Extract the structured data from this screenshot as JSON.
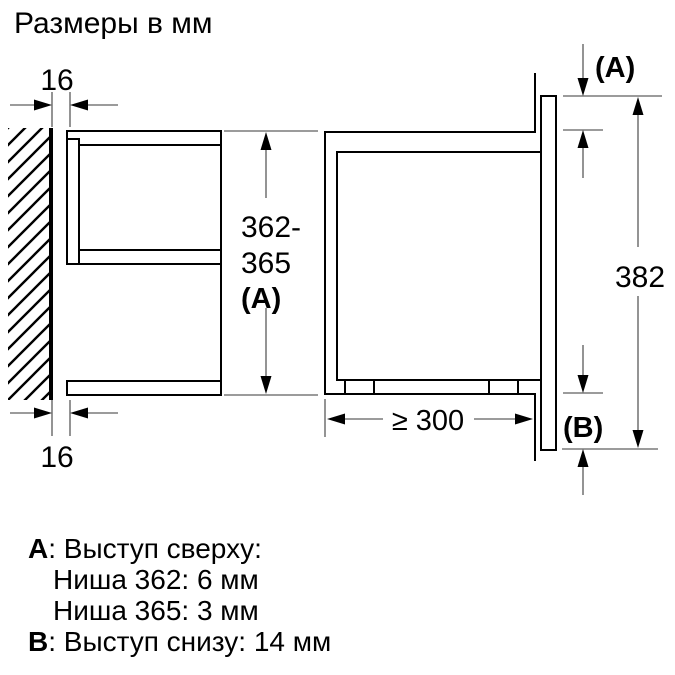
{
  "title": "Размеры в мм",
  "diagram": {
    "dim_top_gap": "16",
    "dim_bottom_gap": "16",
    "dim_niche_line1": "362-",
    "dim_niche_line2": "365",
    "dim_niche_line3": "(A)",
    "dim_height": "382",
    "dim_depth": "≥ 300",
    "label_top_protrusion": "(A)",
    "label_bottom_protrusion": "(B)"
  },
  "legend": {
    "row1_key": "A",
    "row1_text": ": Выступ сверху:",
    "row2_text": "Ниша 362: 6 мм",
    "row3_text": "Ниша 365: 3 мм",
    "row4_key": "B",
    "row4_text": ": Выступ снизу: 14 мм"
  },
  "colors": {
    "object_line": "#000000",
    "dimension_line": "#7a7a7a",
    "background": "#ffffff"
  }
}
